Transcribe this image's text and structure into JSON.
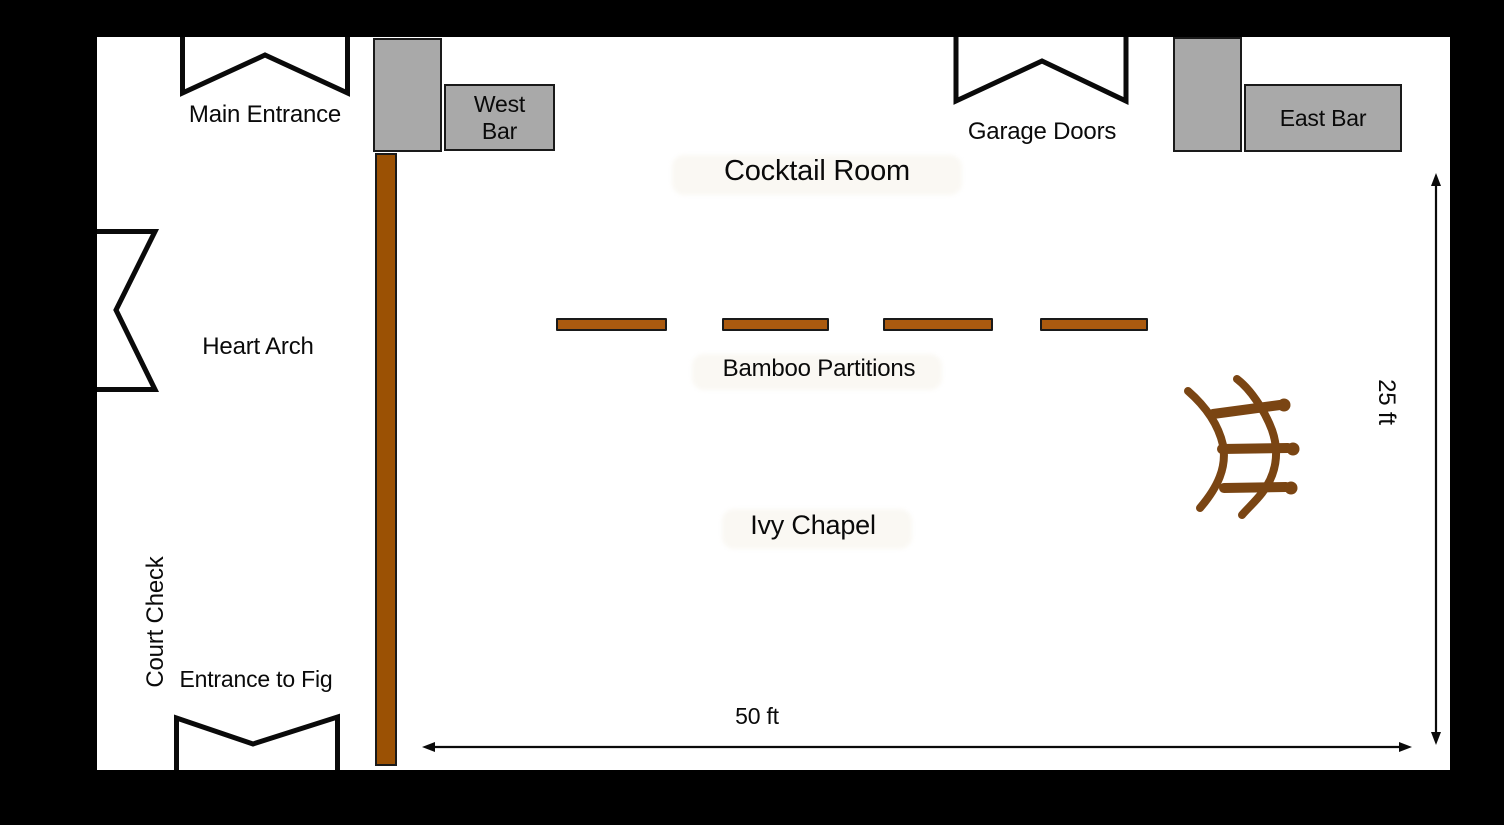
{
  "labels": {
    "main_entrance": "Main Entrance",
    "west_bar": "West Bar",
    "cocktail_room": "Cocktail Room",
    "garage_doors": "Garage Doors",
    "east_bar": "East Bar",
    "heart_arch": "Heart Arch",
    "bamboo_partitions": "Bamboo Partitions",
    "ivy_chapel": "Ivy Chapel",
    "court_check": "Court Check",
    "entrance_to_fig": "Entrance to Fig",
    "room_width": "50 ft",
    "room_height": "25 ft"
  },
  "partitions": {
    "count": 4
  },
  "icons": {
    "door_opening": "angled door-swing / entrance opening symbol",
    "arch_sketch": "hand-drawn bamboo arch (two curved rails, three rungs)",
    "dimension_arrow": "double-headed measurement arrow"
  },
  "colors": {
    "frame_black": "#000000",
    "canvas_white": "#ffffff",
    "bar_gray": "#a9a9a9",
    "wall_brown": "#9b5104",
    "partition_brown": "#aa5a0f",
    "sketch_brown": "#7a4513",
    "line_black": "#0a0a0a"
  }
}
